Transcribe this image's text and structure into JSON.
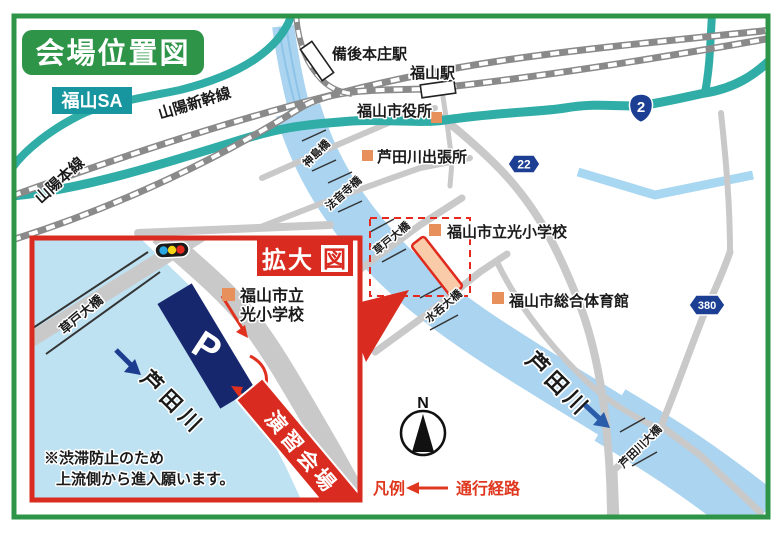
{
  "title": "会場位置図",
  "labels": {
    "fukuyama_sa": "福山SA"
  },
  "railways": {
    "shinkansen": "山陽新幹線",
    "sanyo_line": "山陽本線"
  },
  "stations": {
    "bingo_honjo": "備後本庄駅",
    "fukuyama": "福山駅"
  },
  "landmarks": {
    "city_hall": "福山市役所",
    "river_office": "芦田川出張所",
    "school": "福山市立光小学校",
    "gym": "福山市総合体育館"
  },
  "bridges": {
    "kamishima": "神島橋",
    "hoonji": "法音寺橋",
    "kusado": "草戸大橋",
    "minomi": "水呑大橋",
    "ashidagawa_ohashi": "芦田川大橋"
  },
  "river": {
    "name": "芦田川"
  },
  "route_shields": {
    "national_2": "2",
    "pref_22": "22",
    "route_380": "380"
  },
  "inset": {
    "title_main": "拡大",
    "title_last": "図",
    "school_line1": "福山市立",
    "school_line2": "光小学校",
    "parking": "P",
    "bridge": "草戸大橋",
    "river": "芦田川",
    "banner": "演習会場",
    "note_line1": "※渋滞防止のため",
    "note_line2": "上流側から進入願います。"
  },
  "compass": {
    "north": "N"
  },
  "legend": {
    "title": "凡例",
    "route_label": "通行経路"
  },
  "colors": {
    "frame_green": "#2e9447",
    "teal_road": "#2fada6",
    "sa_teal": "#1796a0",
    "river_blue": "#aad4f0",
    "inset_river_blue": "#bfe2f2",
    "road_gray": "#c9c9ca",
    "railway_gray": "#8a8a8a",
    "red": "#d92b1f",
    "arrow_red": "#e0301e",
    "orange_marker": "#e8905c",
    "navy_parking": "#17276d",
    "shield_blue": "#1c3f94",
    "river_text_blue": "#2a5caa",
    "inset_river_text_blue": "#1c3d8f",
    "legend_red": "#e0381f",
    "venue_fill": "#f9cba8"
  }
}
